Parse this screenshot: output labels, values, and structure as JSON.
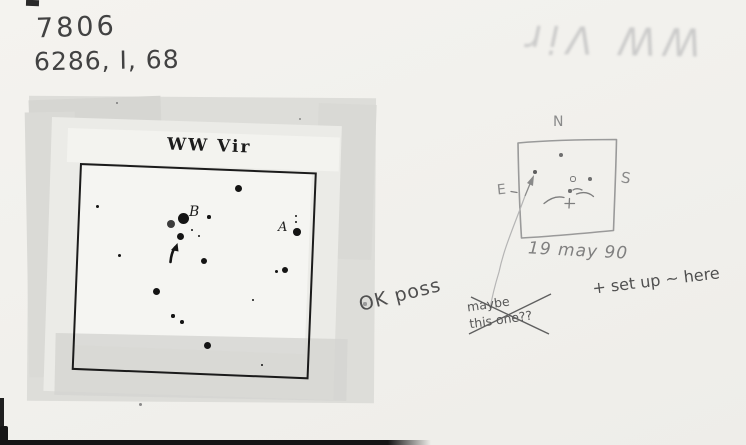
{
  "card": {
    "header": {
      "number": "7806",
      "code": "6286, I, 68"
    },
    "ghost_text": "WW Vir",
    "chart": {
      "title": "WW Vir",
      "label_a": "A",
      "label_b": "B",
      "stars": [
        {
          "x": 238,
          "y": 188,
          "r": 3.5
        },
        {
          "x": 97,
          "y": 206,
          "r": 1.5
        },
        {
          "x": 183,
          "y": 218,
          "r": 5.5
        },
        {
          "x": 171,
          "y": 224,
          "r": 4,
          "c": "#3c3c3c"
        },
        {
          "x": 180,
          "y": 236,
          "r": 3.5
        },
        {
          "x": 209,
          "y": 217,
          "r": 1.8
        },
        {
          "x": 192,
          "y": 230,
          "r": 1.2
        },
        {
          "x": 199,
          "y": 236,
          "r": 1.4
        },
        {
          "x": 296,
          "y": 216,
          "r": 1.1
        },
        {
          "x": 296,
          "y": 222,
          "r": 1.4
        },
        {
          "x": 297,
          "y": 232,
          "r": 3.8
        },
        {
          "x": 119,
          "y": 255,
          "r": 1.5
        },
        {
          "x": 204,
          "y": 261,
          "r": 3
        },
        {
          "x": 276,
          "y": 271,
          "r": 1.5
        },
        {
          "x": 285,
          "y": 270,
          "r": 3.2
        },
        {
          "x": 156,
          "y": 291,
          "r": 3.5
        },
        {
          "x": 253,
          "y": 300,
          "r": 1.4
        },
        {
          "x": 173,
          "y": 316,
          "r": 1.7
        },
        {
          "x": 182,
          "y": 322,
          "r": 1.9
        },
        {
          "x": 207,
          "y": 345,
          "r": 3.5
        },
        {
          "x": 262,
          "y": 365,
          "r": 1
        }
      ],
      "specks": [
        {
          "x": 117,
          "y": 103,
          "r": 1.3,
          "c": "#7a7a7a"
        },
        {
          "x": 300,
          "y": 119,
          "r": 1.3,
          "c": "#8a8a8a"
        },
        {
          "x": 365,
          "y": 304,
          "r": 1.6,
          "c": "#9a9a9a"
        },
        {
          "x": 140,
          "y": 404,
          "r": 1.5,
          "c": "#8a8a8a"
        }
      ]
    },
    "sketch": {
      "north": "N",
      "east": "E",
      "south": "S",
      "date": "19 may 90",
      "dots": [
        {
          "x": 561,
          "y": 155,
          "r": 2.2,
          "c": "#6f6f6f"
        },
        {
          "x": 535,
          "y": 172,
          "r": 1.9,
          "c": "#5f5f5f"
        },
        {
          "x": 572,
          "y": 178,
          "r": 1.6,
          "c": "#7a7a7a",
          "open": true
        },
        {
          "x": 590,
          "y": 179,
          "r": 1.9,
          "c": "#6f6f6f"
        },
        {
          "x": 570,
          "y": 191,
          "r": 1.7,
          "c": "#6f6f6f"
        }
      ]
    },
    "notes": {
      "ok": "OK poss",
      "maybe_line1": "maybe",
      "maybe_line2": "this one??",
      "setup": "+ set up ~ here"
    },
    "colors": {
      "card_bg": "#f1f0ec",
      "pencil_dark": "#4a4a4a",
      "pencil_sketch": "#8a8a8a",
      "print_ink": "#161616",
      "tape_gray": "#d8d8d4",
      "print_paper": "#ebebe7",
      "ghost_gray": "#c4c4c4",
      "edge_black": "#171717"
    }
  }
}
